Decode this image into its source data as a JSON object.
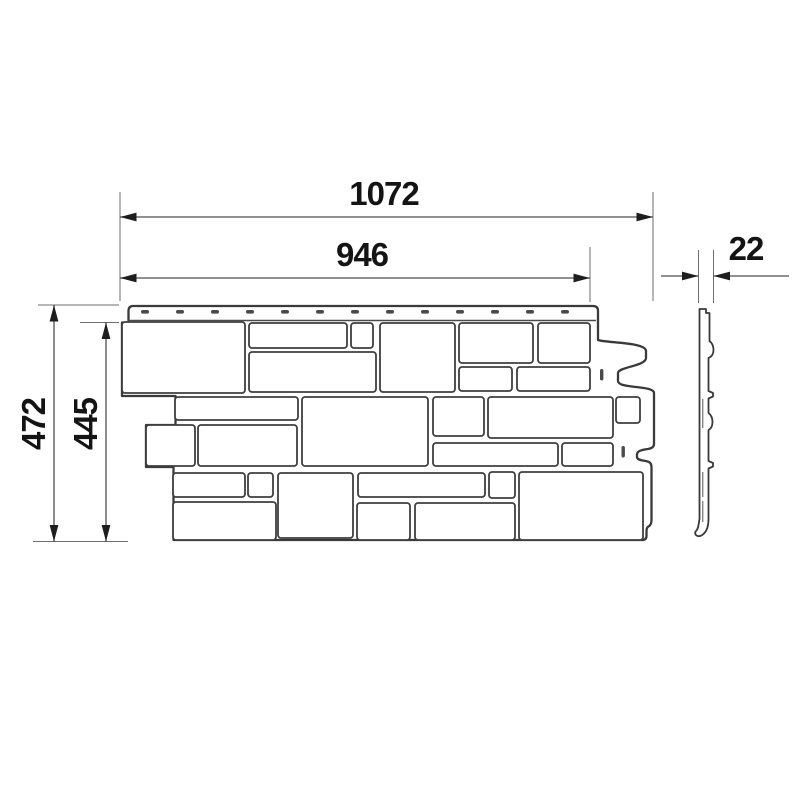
{
  "drawing": {
    "dimensions": {
      "overall_width": "1072",
      "exposed_width": "946",
      "overall_height": "472",
      "exposed_height": "445",
      "thickness": "22"
    },
    "colors": {
      "ink": "#3a3a3a",
      "text": "#141414",
      "background": "#ffffff"
    }
  }
}
